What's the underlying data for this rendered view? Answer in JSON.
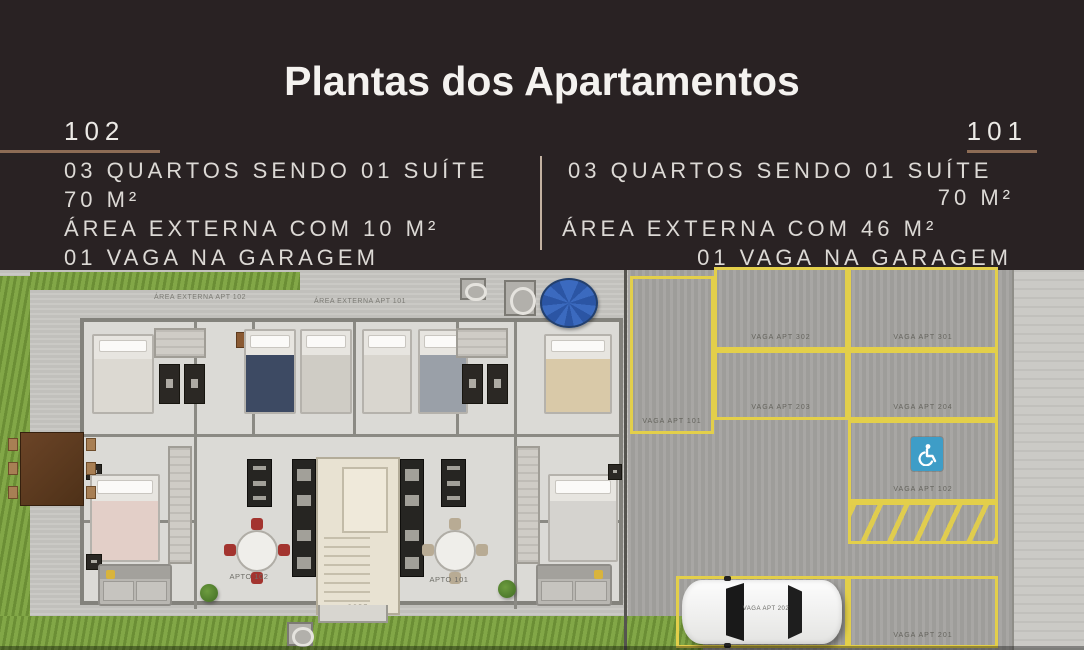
{
  "header": {
    "title": "Plantas dos Apartamentos",
    "left_unit": {
      "number": "102",
      "specs": [
        "03 QUARTOS SENDO 01 SUÍTE",
        "70 M²",
        "ÁREA EXTERNA COM 10 M²",
        "01 VAGA NA GARAGEM"
      ]
    },
    "right_unit": {
      "number": "101",
      "specs": [
        "03 QUARTOS SENDO 01 SUÍTE",
        "70 M²",
        "ÁREA EXTERNA COM 46 M²",
        "01 VAGA NA GARAGEM"
      ]
    }
  },
  "plan": {
    "labels": {
      "area_externa_102": "ÁREA EXTERNA APT 102",
      "area_externa_101": "ÁREA EXTERNA APT 101",
      "apto_102": "APTO 102",
      "apto_101": "APTO 101",
      "sobe": "SOBE"
    },
    "parking": {
      "spaces": [
        {
          "label": "VAGA APT 101"
        },
        {
          "label": "VAGA APT 302"
        },
        {
          "label": "VAGA APT 301"
        },
        {
          "label": "VAGA APT 203"
        },
        {
          "label": "VAGA APT 204"
        },
        {
          "label": "VAGA APT 102"
        },
        {
          "label": "VAGA APT 202"
        },
        {
          "label": "VAGA APT 201"
        }
      ],
      "handicap_icon": "wheelchair-icon"
    }
  },
  "colors": {
    "header_bg": "#292223",
    "accent_rule": "#8d6c55",
    "parking_line_yellow": "#e3cf4a",
    "grass_green": "#7aa23c",
    "handicap_blue": "#3e9dc7",
    "spiral_stair_blue": "#3b6abf"
  }
}
